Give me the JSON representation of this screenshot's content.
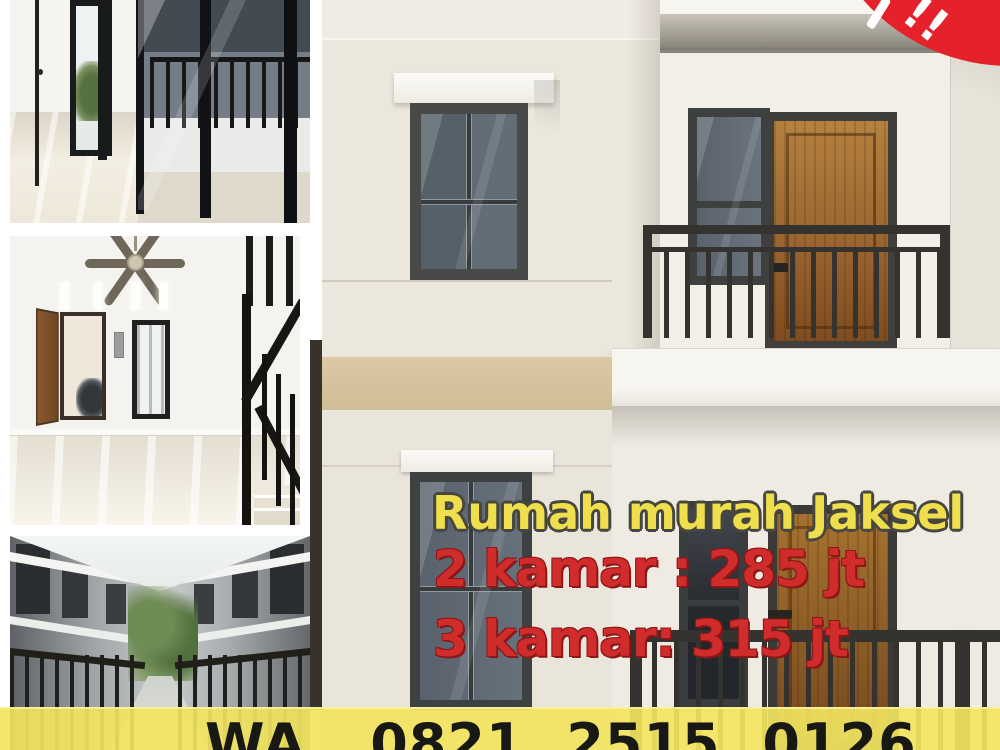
{
  "ad": {
    "headline": "Rumah murah Jaksel",
    "price_line_1": "2 kamar : 285 jt",
    "price_line_2": "3 kamar: 315 jt",
    "contact_label": "WA. 0821 2515 0126",
    "badge_text": "!!"
  },
  "listing": {
    "location": "Jaksel",
    "offers": [
      {
        "bedrooms": 2,
        "price": "285 jt"
      },
      {
        "bedrooms": 3,
        "price": "315 jt"
      }
    ],
    "whatsapp": "0821 2515 0126"
  },
  "photos": [
    {
      "name": "interior-room-balcony-doors",
      "description": "Empty room with glossy tile floor, narrow black-framed window and sliding glass doors to a balcony"
    },
    {
      "name": "interior-living-room-stairs",
      "description": "Living room with ceiling fan, transom slots, open wooden door with motorbike outside, narrow window and black stair railing"
    },
    {
      "name": "townhouse-alley",
      "description": "Alley between two rows of grey townhouses with black fences and greenery at the end"
    },
    {
      "name": "house-facade",
      "description": "Two-storey cream house facade with balcony, brown wooden doors, dark-framed windows and black railings"
    }
  ],
  "colors": {
    "headline_yellow": "#F0DF4C",
    "price_red": "#D02C2C",
    "contact_bar_yellow": "#F2E45F",
    "badge_red": "#E5212B",
    "wall_cream": "#ECE7DD",
    "band_beige": "#D9C7A0",
    "door_brown": "#9A6530",
    "frame_dark": "#3E4142",
    "railing_black": "#34322E"
  }
}
